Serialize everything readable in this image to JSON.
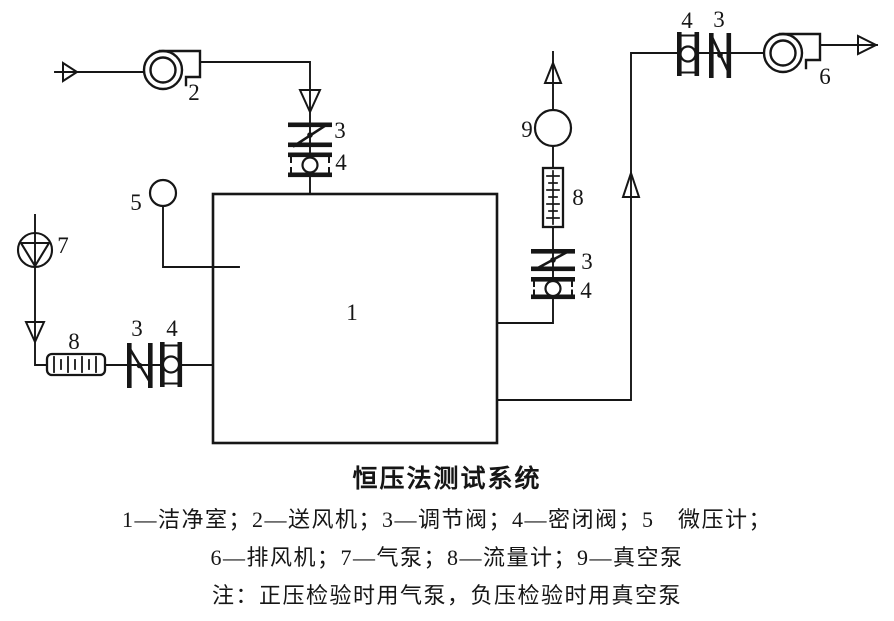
{
  "figure": {
    "title": "恒压法测试系统",
    "legend": {
      "line1": "1—洁净室；2—送风机；3—调节阀；4—密闭阀；5　微压计；",
      "line2": "6—排风机；7—气泵；8—流量计；9—真空泵",
      "note": "注：正压检验时用气泵，负压检验时用真空泵"
    },
    "labels": {
      "clean_room": "1",
      "supply_fan": "2",
      "regulating_valve": "3",
      "sealing_valve": "4",
      "micro_manometer": "5",
      "exhaust_fan": "6",
      "air_pump": "7",
      "flow_meter": "8",
      "vacuum_pump": "9"
    },
    "colors": {
      "ink": "#161616",
      "paper": "#ffffff"
    }
  }
}
